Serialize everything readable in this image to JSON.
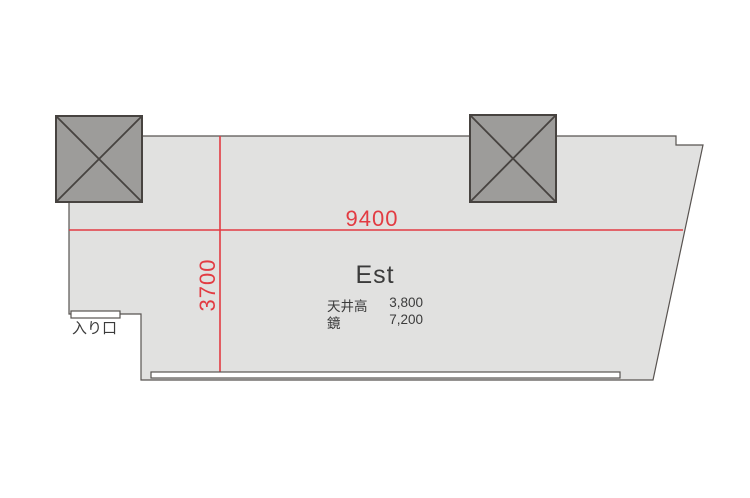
{
  "plan": {
    "room_name": "Est",
    "dimensions": {
      "width_label": "9400",
      "depth_label": "3700"
    },
    "specs": [
      {
        "label": "天井高",
        "value": "3,800"
      },
      {
        "label": "鏡",
        "value": "7,200"
      }
    ],
    "entrance_label": "入り口",
    "colors": {
      "room_fill": "#e1e1e0",
      "outline": "#585350",
      "pillar_fill": "#9d9c9a",
      "pillar_border": "#474340",
      "dimension_red": "#e23b42",
      "text_dark": "#3b3b3b"
    }
  }
}
